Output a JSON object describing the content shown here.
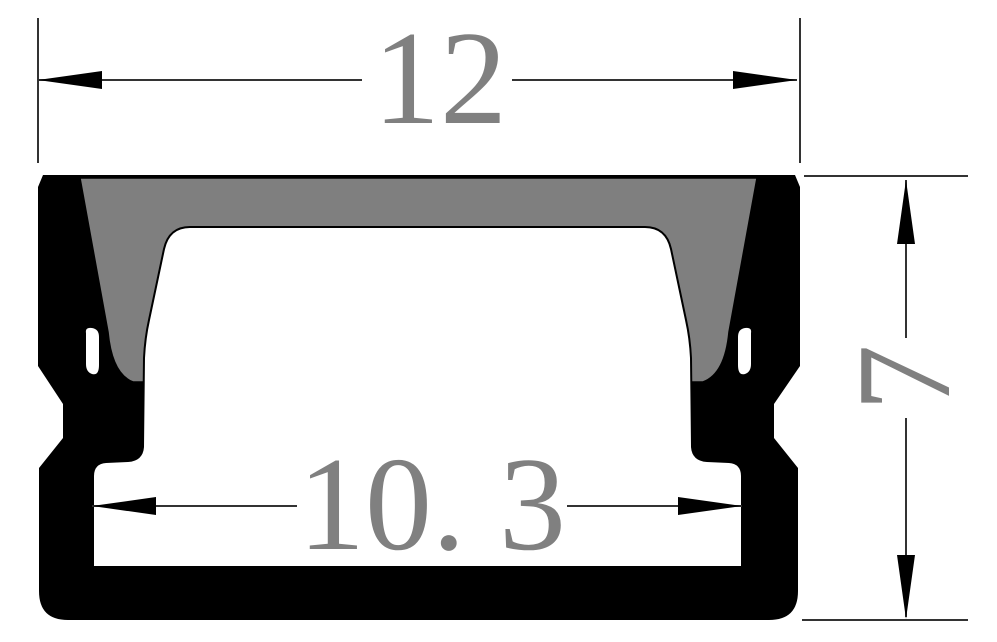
{
  "drawing": {
    "type": "profile-cross-section",
    "dimensions": {
      "width_top": {
        "label": "12"
      },
      "inner_width": {
        "label": "10. 3"
      },
      "height": {
        "label": "7"
      }
    },
    "colors": {
      "background": "#ffffff",
      "outline": "#000000",
      "section_fill": "#7f7f7f",
      "dimension_line": "#333333",
      "dimension_text": "#808080"
    }
  }
}
